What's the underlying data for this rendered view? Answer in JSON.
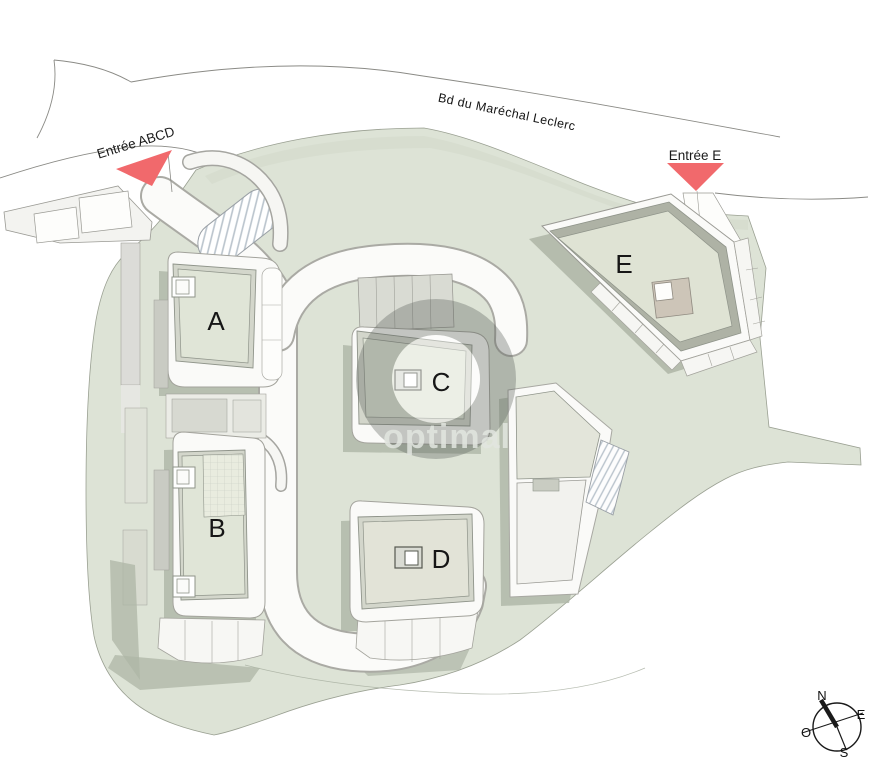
{
  "plan": {
    "title": "Plan de masse résidence",
    "street": "Bd du Maréchal Leclerc",
    "entrance_abcd": "Entrée ABCD",
    "entrance_e": "Entrée E",
    "buildings": {
      "a": "A",
      "b": "B",
      "c": "C",
      "d": "D",
      "e": "E"
    },
    "watermark": "optimal",
    "compass": {
      "n": "N",
      "e": "E",
      "s": "S",
      "o": "O"
    },
    "colors": {
      "landscape": "#dde3d6",
      "landscape_dark_band": "#d2d9cb",
      "roof_green": "#e0e5d7",
      "building_band": "#d3d6cb",
      "building_outer": "#fafaf8",
      "shadow": "#aeb5a6",
      "entrance_marker": "#f1696c",
      "road_casing": "#a3a39c",
      "tan_block": "#cdc5b8",
      "watermark_ring": "rgba(88,93,88,0.34)"
    }
  }
}
